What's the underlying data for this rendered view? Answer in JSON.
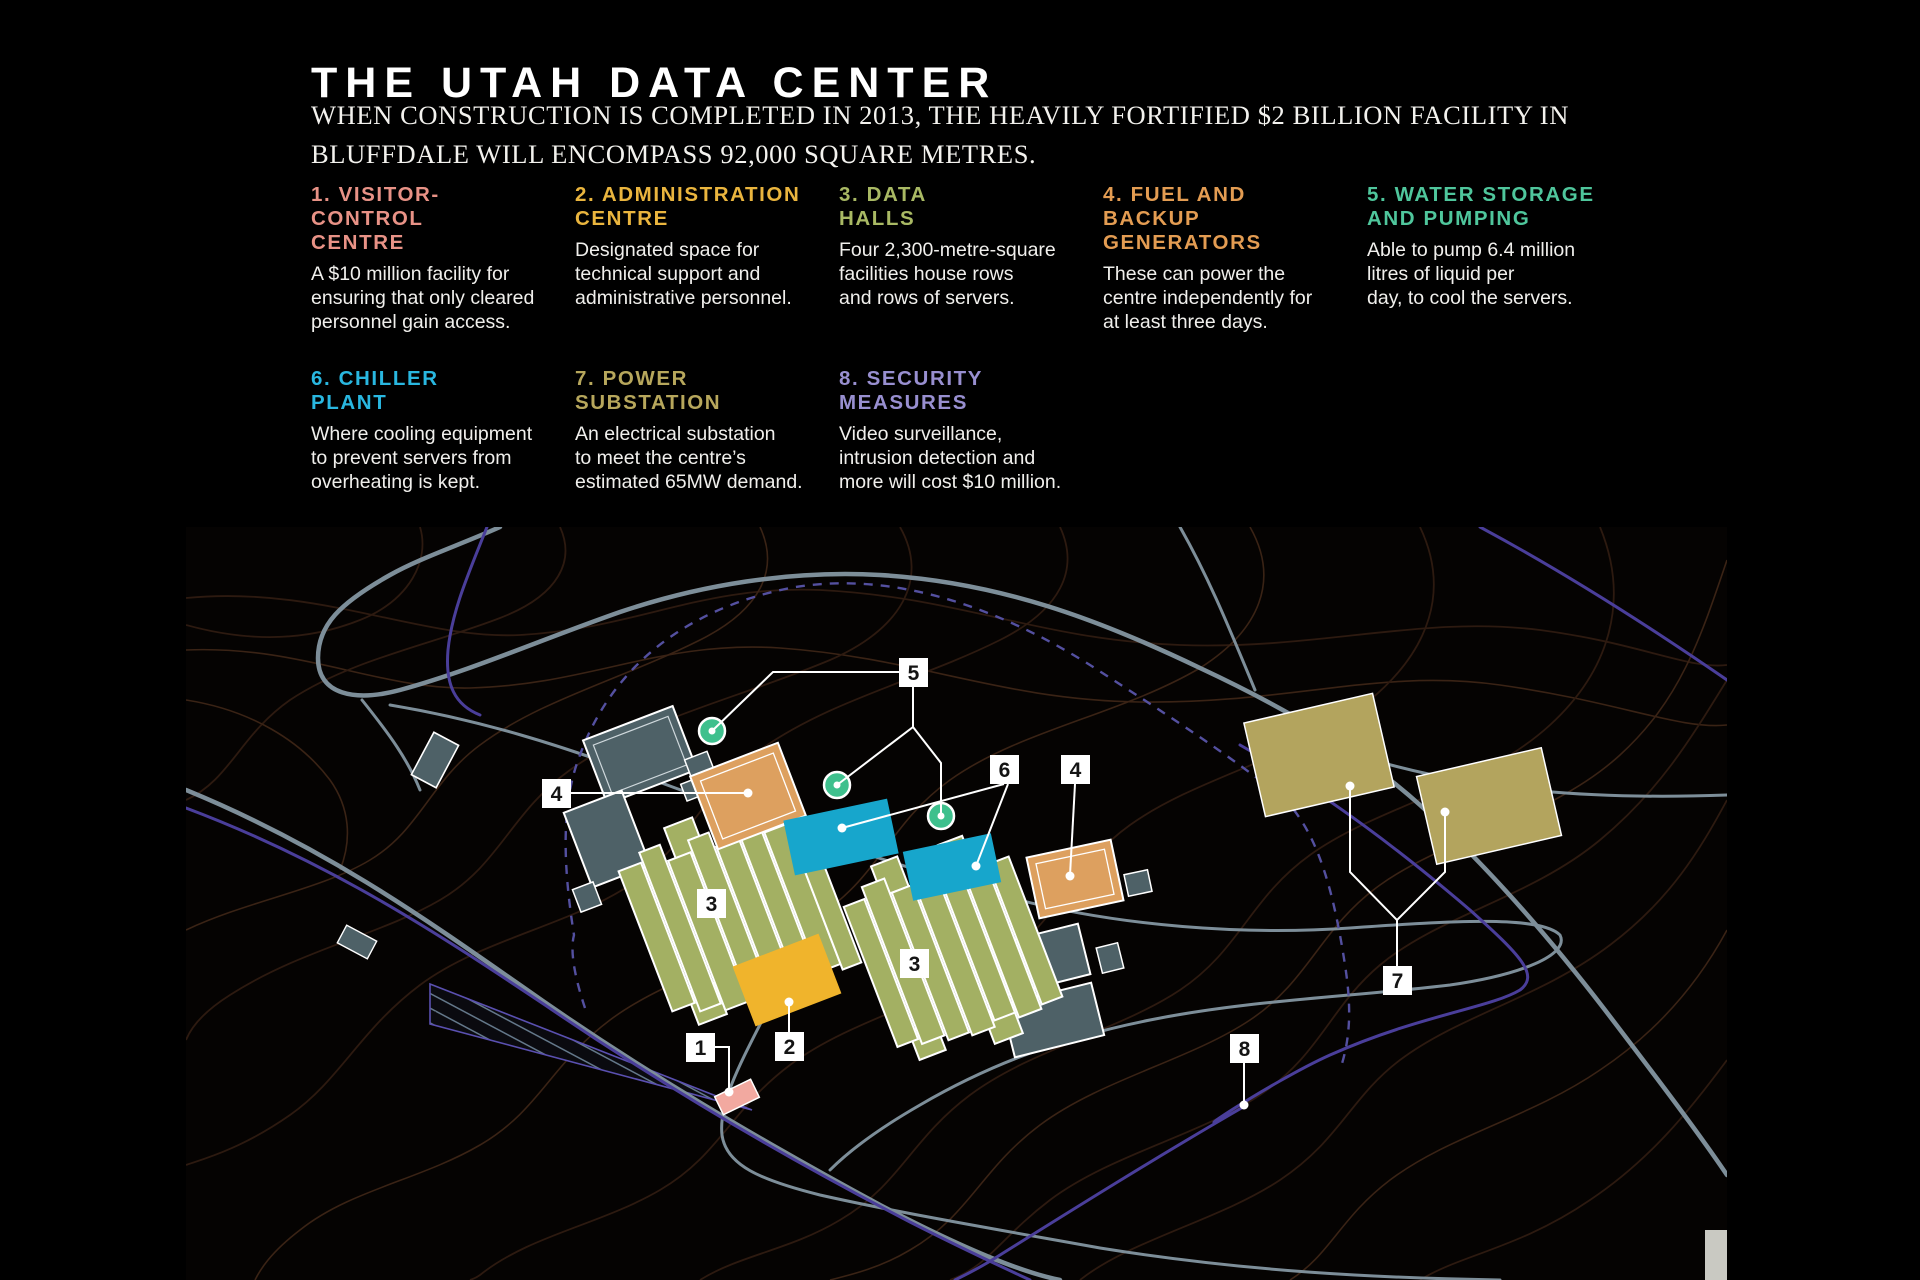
{
  "header": {
    "title": "THE UTAH DATA CENTER",
    "subtitle": "WHEN CONSTRUCTION IS COMPLETED IN 2013, THE HEAVILY FORTIFIED $2 BILLION FACILITY IN\nBLUFFDALE WILL ENCOMPASS 92,000 SQUARE METRES."
  },
  "legend": {
    "items": [
      {
        "num": "1",
        "heading": "1. VISITOR-CONTROL\nCENTRE",
        "body": "A $10 million facility for\nensuring that only cleared\npersonnel gain access.",
        "color": "#e89286"
      },
      {
        "num": "2",
        "heading": "2. ADMINISTRATION\nCENTRE",
        "body": "Designated space for\ntechnical support and\nadministrative personnel.",
        "color": "#eab53e"
      },
      {
        "num": "3",
        "heading": "3. DATA\nHALLS",
        "body": "Four 2,300-metre-square\nfacilities house rows\nand rows of servers.",
        "color": "#a9b964"
      },
      {
        "num": "4",
        "heading": "4. FUEL AND BACKUP\nGENERATORS",
        "body": "These can power the\ncentre independently for\nat least three days.",
        "color": "#e39c52"
      },
      {
        "num": "5",
        "heading": "5. WATER STORAGE\nAND PUMPING",
        "body": "Able to pump 6.4 million\nlitres of liquid per\nday, to cool the servers.",
        "color": "#4fc69c"
      },
      {
        "num": "6",
        "heading": "6. CHILLER\nPLANT",
        "body": "Where cooling equipment\nto prevent servers from\noverheating is kept.",
        "color": "#29b7e0"
      },
      {
        "num": "7",
        "heading": "7. POWER\nSUBSTATION",
        "body": "An electrical substation\nto meet the centre’s\nestimated 65MW demand.",
        "color": "#b7a75c"
      },
      {
        "num": "8",
        "heading": "8. SECURITY\nMEASURES",
        "body": "Video surveillance,\nintrusion detection and\nmore will cost $10 million.",
        "color": "#988fd0"
      }
    ]
  },
  "map": {
    "markers": [
      "5",
      "4",
      "6",
      "4",
      "3",
      "3",
      "1",
      "2",
      "8",
      "7"
    ],
    "colors": {
      "road": "#7d8e99",
      "perimeter_purple": "#4a3e9a",
      "contour": "#2d1a10",
      "visitor_centre_pink": "#f2a9a0",
      "administration_yellow": "#f0b42c",
      "data_hall_olive": "#a3b063",
      "generator_orange": "#dda05f",
      "water_storage_green": "#3ec08d",
      "chiller_cyan": "#17a6cc",
      "substation_khaki": "#b3a45e",
      "support_slate": "#4e6167"
    }
  }
}
